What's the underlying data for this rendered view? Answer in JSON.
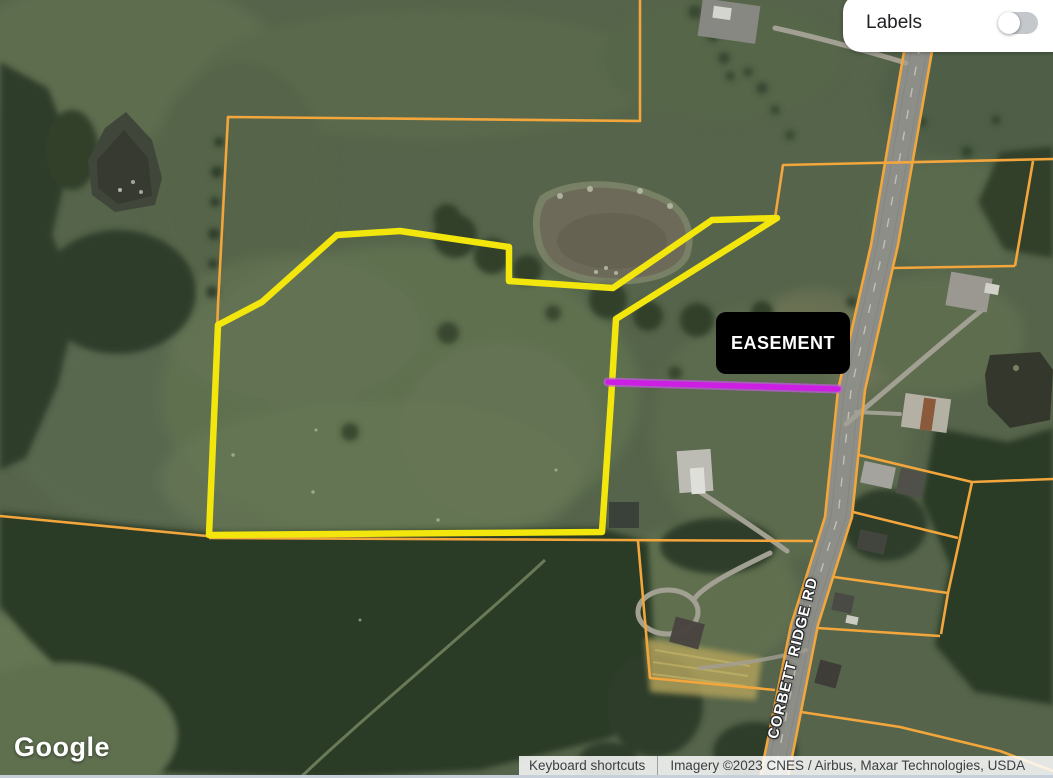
{
  "map": {
    "road_label": "CORBETT RIDGE RD",
    "easement_label": "EASEMENT"
  },
  "controls": {
    "labels": {
      "label": "Labels",
      "state": "off"
    }
  },
  "branding": {
    "logo_text": "Google"
  },
  "attribution": {
    "keyboard_shortcuts": "Keyboard shortcuts",
    "imagery": "Imagery ©2023 CNES / Airbus, Maxar Technologies, USDA"
  },
  "colors": {
    "parcel_line": "#f3a63c",
    "selected_parcel": "#f2e60d",
    "easement_core": "#cd1fe4",
    "easement_halo": "#bb5fd6",
    "label_bg": "#000000",
    "label_text": "#ffffff"
  },
  "overlays": {
    "parcel_lines": [
      {
        "points": "640,0 640,121 228,117 218,305 210,520"
      },
      {
        "points": "0,516 207,536"
      },
      {
        "points": "209,538 813,541"
      },
      {
        "points": "638,541 650,678 775,690"
      },
      {
        "points": "775,218 783,165 1053,159"
      },
      {
        "points": "1033,161 1015,266"
      },
      {
        "points": "892,268 1015,266"
      },
      {
        "points": "906,40 871,245 838,390 825,517 791,625 760,778"
      },
      {
        "points": "934,40 898,245 865,390 852,517 818,625 788,778"
      },
      {
        "points": "859,455 972,482 1053,479"
      },
      {
        "points": "972,482 960,538 948,593 941,634"
      },
      {
        "points": "853,512 958,538"
      },
      {
        "points": "834,577 948,593"
      },
      {
        "points": "817,628 940,636"
      },
      {
        "points": "801,712 900,727 1000,751 1053,771"
      }
    ],
    "selected_parcel_points": "218,325 262,302 337,235 400,231 509,247 509,281 613,288 712,220 777,218 616,319 611,400 602,532 209,535",
    "easement_line": {
      "x1": 608,
      "y1": 382,
      "x2": 838,
      "y2": 389
    }
  }
}
